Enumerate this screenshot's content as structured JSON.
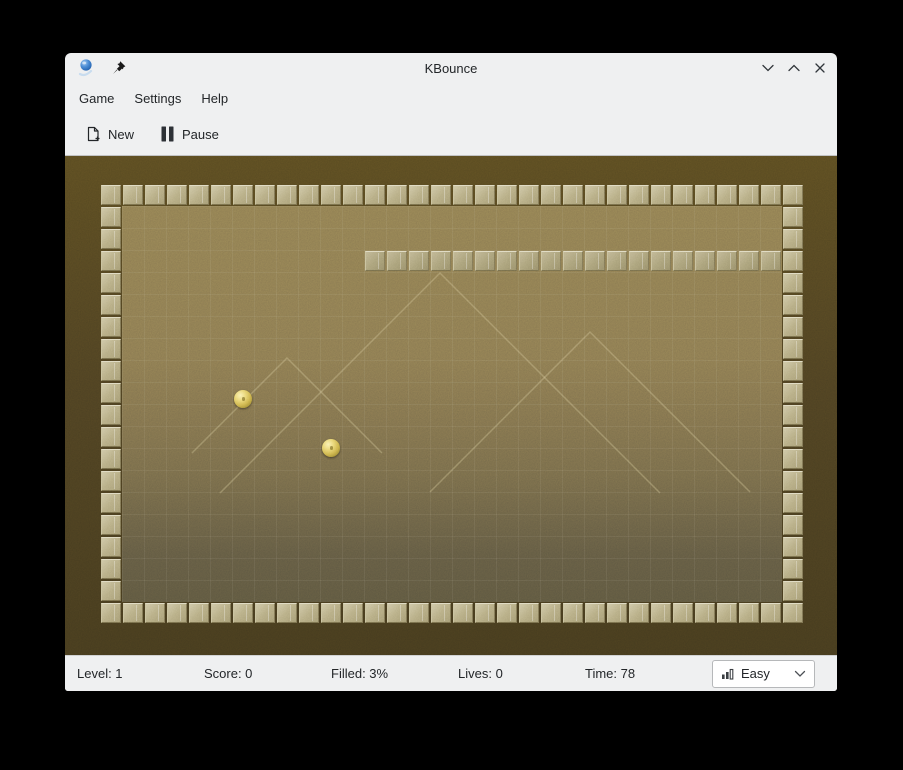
{
  "window": {
    "title": "KBounce",
    "icons": {
      "app": "kbounce-ball-icon",
      "pin": "pushpin-icon",
      "minimize": "chevron-down-icon",
      "maximize": "chevron-up-icon",
      "close": "close-x-icon"
    }
  },
  "menu": {
    "items": [
      {
        "label": "Game"
      },
      {
        "label": "Settings"
      },
      {
        "label": "Help"
      }
    ]
  },
  "toolbar": {
    "buttons": [
      {
        "label": "New",
        "icon": "new-document-icon"
      },
      {
        "label": "Pause",
        "icon": "pause-icon"
      }
    ]
  },
  "statusbar": {
    "items": [
      "Level: 1",
      "Score: 0",
      "Filled: 3%",
      "Lives: 0",
      "Time: 78"
    ],
    "difficulty": {
      "value": "Easy",
      "icon": "difficulty-bars-icon"
    }
  },
  "game": {
    "colors": {
      "window_bg": "#eff0f1",
      "text": "#232629",
      "board_outer": "#4c4022",
      "board_inner_top": "#8d7c52",
      "board_inner_bottom": "#5c5640",
      "tile": "#b4ab85",
      "tile_filled": "#a8a07b",
      "ball": "#e9d678"
    },
    "board": {
      "cols": 32,
      "rows": 20,
      "tile_px": 22,
      "origin": {
        "x": 35,
        "y": 28
      },
      "walls": {
        "top_row": 0,
        "bottom_row": 19,
        "left_col": 0,
        "right_col": 31
      },
      "filled": {
        "row": 3,
        "col_start": 12,
        "col_end": 30
      },
      "balls": [
        {
          "cx": 143,
          "cy": 215,
          "d": 18
        },
        {
          "cx": 231,
          "cy": 264,
          "d": 18
        }
      ],
      "pyramids": [
        {
          "x": 340,
          "y": 89,
          "len": 220
        },
        {
          "x": 490,
          "y": 148,
          "len": 160
        },
        {
          "x": 187,
          "y": 174,
          "len": 95
        }
      ]
    }
  }
}
